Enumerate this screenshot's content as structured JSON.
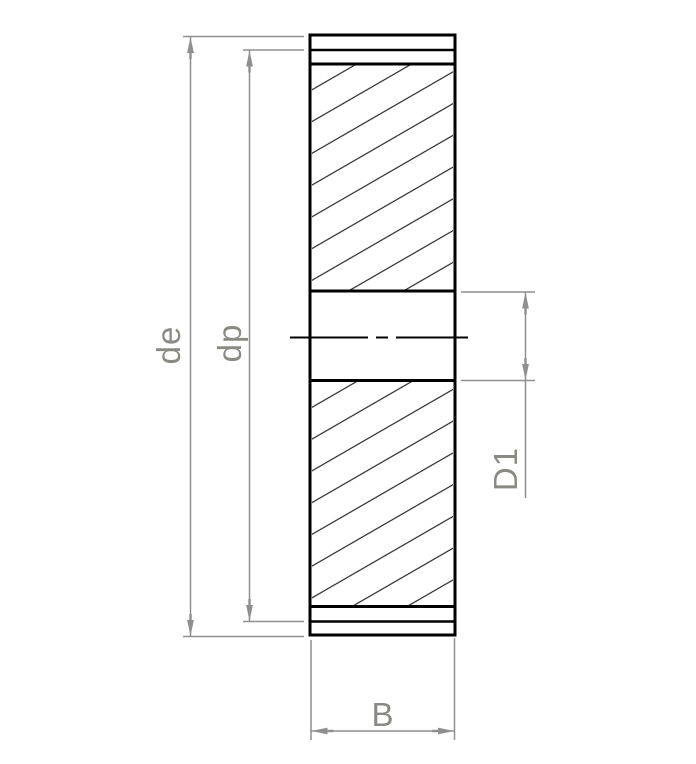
{
  "drawing": {
    "type": "gear-cross-section",
    "labels": {
      "outer_diameter": "de",
      "pitch_diameter": "dp",
      "bore_diameter": "D1",
      "face_width": "B"
    },
    "colors": {
      "background": "#ffffff",
      "outline": "#000000",
      "dimension_lines": "#8f8f8f",
      "label_text": "#8a8a85"
    },
    "hatch": {
      "angle_deg": 30,
      "spacing_px": 27.5
    }
  }
}
